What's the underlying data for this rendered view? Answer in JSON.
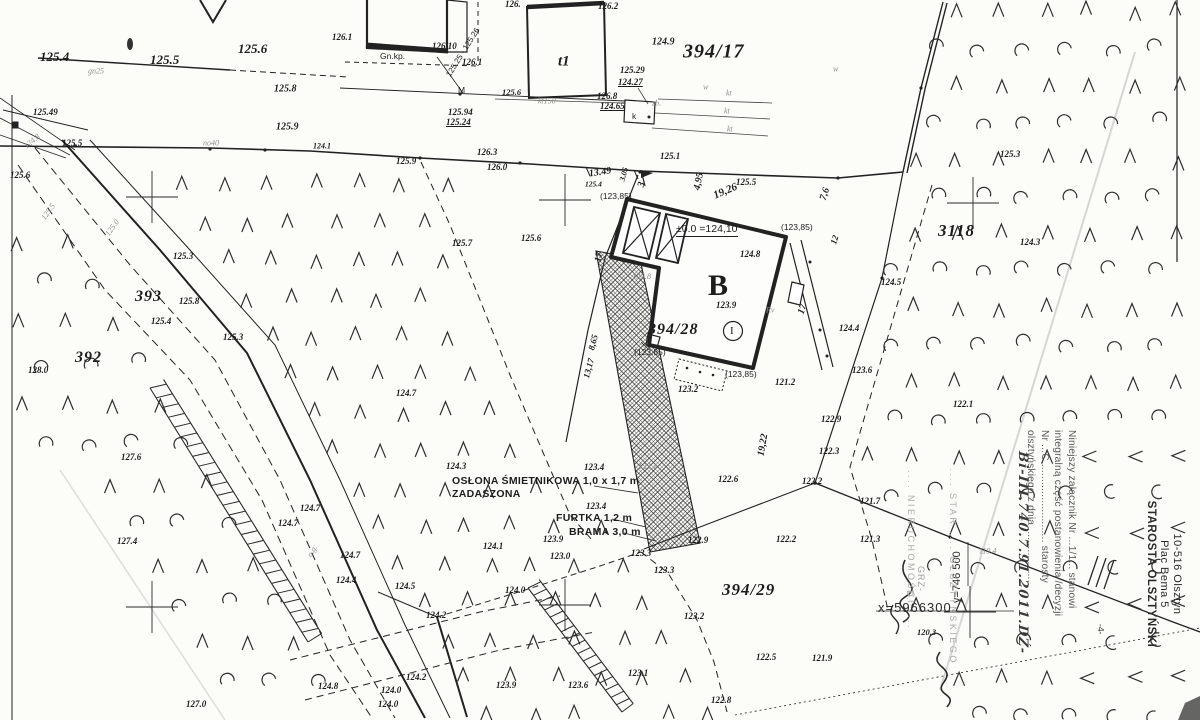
{
  "colors": {
    "ink": "#1d1d1d",
    "faint": "#8e8e8e",
    "pencil": "#bdbdbd",
    "paper": "#fcfcf8"
  },
  "labels": {
    "plot_numbers": [
      {
        "t": "394/17",
        "x": 683,
        "y": 52,
        "s": 20
      },
      {
        "t": "394/28",
        "x": 648,
        "y": 330,
        "s": 16
      },
      {
        "t": "394/29",
        "x": 722,
        "y": 590,
        "s": 17
      },
      {
        "t": "393",
        "x": 135,
        "y": 297,
        "s": 16
      },
      {
        "t": "392",
        "x": 75,
        "y": 358,
        "s": 16
      },
      {
        "t": "3118",
        "x": 938,
        "y": 231,
        "s": 17
      },
      {
        "t": "B",
        "x": 708,
        "y": 286,
        "k": "bB"
      },
      {
        "t": "t1",
        "x": 558,
        "y": 62,
        "k": "bldg"
      },
      {
        "t": "I",
        "x": 730,
        "y": 331,
        "k": "rom"
      }
    ],
    "spot_heights": [
      {
        "t": "125.4",
        "x": 40,
        "y": 57,
        "s": 13
      },
      {
        "t": "125.5",
        "x": 150,
        "y": 60,
        "s": 13
      },
      {
        "t": "125.6",
        "x": 238,
        "y": 49,
        "s": 13
      },
      {
        "t": "125.49",
        "x": 33,
        "y": 112
      },
      {
        "t": "125.5",
        "x": 62,
        "y": 143
      },
      {
        "t": "125.8",
        "x": 274,
        "y": 89,
        "s": 10
      },
      {
        "t": "125.9",
        "x": 276,
        "y": 127,
        "s": 10
      },
      {
        "t": "124.1",
        "x": 313,
        "y": 146,
        "s": 8
      },
      {
        "t": "126.1",
        "x": 332,
        "y": 37
      },
      {
        "t": "126.10",
        "x": 432,
        "y": 46
      },
      {
        "t": "126.1",
        "x": 462,
        "y": 62
      },
      {
        "t": "125.94",
        "x": 448,
        "y": 112
      },
      {
        "t": "125.24",
        "x": 446,
        "y": 122,
        "u": 1
      },
      {
        "t": "126.",
        "x": 505,
        "y": 4
      },
      {
        "t": "126.2",
        "x": 598,
        "y": 6
      },
      {
        "t": "124.9",
        "x": 652,
        "y": 42,
        "s": 10
      },
      {
        "t": "125.29",
        "x": 620,
        "y": 70
      },
      {
        "t": "124.27",
        "x": 618,
        "y": 82,
        "u": 1
      },
      {
        "t": "125.6",
        "x": 502,
        "y": 92,
        "s": 8.5
      },
      {
        "t": "126.8",
        "x": 597,
        "y": 96
      },
      {
        "t": "124.65",
        "x": 600,
        "y": 106,
        "u": 1
      },
      {
        "t": "126.3",
        "x": 477,
        "y": 152
      },
      {
        "t": "126.0",
        "x": 487,
        "y": 167
      },
      {
        "t": "125.9",
        "x": 396,
        "y": 161
      },
      {
        "t": "125.7",
        "x": 452,
        "y": 243
      },
      {
        "t": "125.6",
        "x": 521,
        "y": 238
      },
      {
        "t": "125.1",
        "x": 660,
        "y": 156
      },
      {
        "t": "125.5",
        "x": 736,
        "y": 182
      },
      {
        "t": "125.4",
        "x": 585,
        "y": 184,
        "s": 7.5
      },
      {
        "t": "124.8",
        "x": 740,
        "y": 254
      },
      {
        "t": "123.9",
        "x": 716,
        "y": 305
      },
      {
        "t": "123.8",
        "x": 632,
        "y": 276,
        "k": "gy",
        "s": 8.5
      },
      {
        "t": "123.2",
        "x": 678,
        "y": 389
      },
      {
        "t": "121.2",
        "x": 775,
        "y": 382
      },
      {
        "t": "124.5",
        "x": 881,
        "y": 282
      },
      {
        "t": "124.4",
        "x": 839,
        "y": 328
      },
      {
        "t": "123.6",
        "x": 852,
        "y": 370
      },
      {
        "t": "122.9",
        "x": 821,
        "y": 419
      },
      {
        "t": "122.1",
        "x": 953,
        "y": 404
      },
      {
        "t": "122.3",
        "x": 819,
        "y": 451
      },
      {
        "t": "122.2",
        "x": 802,
        "y": 481
      },
      {
        "t": "121.7",
        "x": 860,
        "y": 501
      },
      {
        "t": "121.3",
        "x": 860,
        "y": 539
      },
      {
        "t": "120.3",
        "x": 917,
        "y": 632,
        "s": 8.5
      },
      {
        "t": "121.9",
        "x": 812,
        "y": 658
      },
      {
        "t": "119.4",
        "x": 979,
        "y": 551,
        "k": "gy"
      },
      {
        "t": "122.6",
        "x": 718,
        "y": 479
      },
      {
        "t": "125.6",
        "x": 10,
        "y": 175
      },
      {
        "t": "125.3",
        "x": 173,
        "y": 256
      },
      {
        "t": "125.8",
        "x": 179,
        "y": 301
      },
      {
        "t": "125.4",
        "x": 151,
        "y": 321
      },
      {
        "t": "125.3",
        "x": 223,
        "y": 337
      },
      {
        "t": "128.0",
        "x": 28,
        "y": 370
      },
      {
        "t": "127.6",
        "x": 121,
        "y": 457
      },
      {
        "t": "127.4",
        "x": 117,
        "y": 541
      },
      {
        "t": "127.0",
        "x": 186,
        "y": 704
      },
      {
        "t": "124.7",
        "x": 396,
        "y": 393
      },
      {
        "t": "124.7",
        "x": 300,
        "y": 508
      },
      {
        "t": "124.7",
        "x": 278,
        "y": 523
      },
      {
        "t": "124.7",
        "x": 340,
        "y": 555
      },
      {
        "t": "124.4",
        "x": 336,
        "y": 580
      },
      {
        "t": "124.5",
        "x": 395,
        "y": 586
      },
      {
        "t": "124.2",
        "x": 426,
        "y": 615
      },
      {
        "t": "124.0",
        "x": 505,
        "y": 590
      },
      {
        "t": "124.2",
        "x": 406,
        "y": 677
      },
      {
        "t": "124.8",
        "x": 318,
        "y": 686
      },
      {
        "t": "124.0",
        "x": 381,
        "y": 690
      },
      {
        "t": "124.0",
        "x": 378,
        "y": 704
      },
      {
        "t": "123.9",
        "x": 496,
        "y": 685
      },
      {
        "t": "123.6",
        "x": 568,
        "y": 685
      },
      {
        "t": "124.3",
        "x": 446,
        "y": 466
      },
      {
        "t": "123.4",
        "x": 584,
        "y": 467
      },
      {
        "t": "123.4",
        "x": 586,
        "y": 506
      },
      {
        "t": "123.9",
        "x": 543,
        "y": 539
      },
      {
        "t": "124.1",
        "x": 483,
        "y": 546
      },
      {
        "t": "123.0",
        "x": 550,
        "y": 556
      },
      {
        "t": "123.1",
        "x": 638,
        "y": 466,
        "k": "gy",
        "s": 8.5
      },
      {
        "t": "122.9",
        "x": 688,
        "y": 540
      },
      {
        "t": "122.2",
        "x": 776,
        "y": 539
      },
      {
        "t": "123.3",
        "x": 631,
        "y": 553
      },
      {
        "t": "123.3",
        "x": 654,
        "y": 570
      },
      {
        "t": "123.2",
        "x": 684,
        "y": 616
      },
      {
        "t": "122.5",
        "x": 756,
        "y": 657
      },
      {
        "t": "123.1",
        "x": 628,
        "y": 673
      },
      {
        "t": "122.8",
        "x": 711,
        "y": 700
      },
      {
        "t": "125.3",
        "x": 1000,
        "y": 154
      },
      {
        "t": "124.3",
        "x": 1020,
        "y": 242
      }
    ],
    "dimensions": [
      {
        "t": "13.49",
        "x": 589,
        "y": 174,
        "r": -8
      },
      {
        "t": "3.05",
        "x": 622,
        "y": 181,
        "r": -75,
        "s": 8
      },
      {
        "t": "3",
        "x": 641,
        "y": 187,
        "r": -75
      },
      {
        "t": "4,95",
        "x": 697,
        "y": 190,
        "r": -78
      },
      {
        "t": "19,26",
        "x": 714,
        "y": 196,
        "r": -23,
        "s": 11
      },
      {
        "t": "7,6",
        "x": 823,
        "y": 200,
        "r": -72
      },
      {
        "t": "12",
        "x": 833,
        "y": 244,
        "r": -72,
        "s": 9
      },
      {
        "t": "17",
        "x": 598,
        "y": 262,
        "r": -78
      },
      {
        "t": "17",
        "x": 801,
        "y": 314,
        "r": -72
      },
      {
        "t": "8,65",
        "x": 591,
        "y": 350,
        "r": -75,
        "s": 9
      },
      {
        "t": "13,17",
        "x": 586,
        "y": 378,
        "r": -75,
        "s": 9
      },
      {
        "t": "19,22",
        "x": 761,
        "y": 456,
        "r": -80
      }
    ],
    "levels_paren": [
      {
        "t": "(123,85)",
        "x": 600,
        "y": 196
      },
      {
        "t": "(123,85)",
        "x": 781,
        "y": 227
      },
      {
        "t": "(123,85)",
        "x": 634,
        "y": 352
      },
      {
        "t": "(123,85)",
        "x": 725,
        "y": 374
      }
    ],
    "utilities": [
      {
        "t": "gn25",
        "x": 88,
        "y": 71
      },
      {
        "t": "no40",
        "x": 203,
        "y": 143
      },
      {
        "t": "kt150",
        "x": 538,
        "y": 101
      },
      {
        "t": "kt",
        "x": 726,
        "y": 93
      },
      {
        "t": "kt",
        "x": 724,
        "y": 111
      },
      {
        "t": "kt",
        "x": 727,
        "y": 129
      },
      {
        "t": "w",
        "x": 833,
        "y": 69
      },
      {
        "t": "w",
        "x": 703,
        "y": 87
      },
      {
        "t": "zb.",
        "x": 652,
        "y": 103
      },
      {
        "t": "k",
        "x": 632,
        "y": 116,
        "k": "par"
      },
      {
        "t": "Gn.kp.",
        "x": 380,
        "y": 56,
        "k": "par"
      },
      {
        "t": "M",
        "x": 458,
        "y": 90,
        "k": "par"
      },
      {
        "t": "o.g.",
        "x": 309,
        "y": 556,
        "r": -58
      },
      {
        "t": "125.5",
        "x": 43,
        "y": 219,
        "r": -55
      },
      {
        "t": "125.0",
        "x": 107,
        "y": 235,
        "r": -55
      },
      {
        "t": "124.8",
        "x": 25,
        "y": 147,
        "r": -40
      },
      {
        "t": "Rv",
        "x": 766,
        "y": 310
      },
      {
        "t": "125.25 · 125.26",
        "x": 448,
        "y": 76,
        "r": -58,
        "k": "par",
        "s": 8
      }
    ],
    "annotations": [
      {
        "t": "OSŁONA ŚMIETNIKOWA 1,0 x 1,7 m",
        "x": 452,
        "y": 481
      },
      {
        "t": "ZADASZONA",
        "x": 452,
        "y": 494
      },
      {
        "t": "FURTKA 1,2 m",
        "x": 556,
        "y": 518
      },
      {
        "t": "BRAMA 3,0 m",
        "x": 569,
        "y": 532
      },
      {
        "t": "±0.0 =124,10",
        "x": 676,
        "y": 230,
        "k": "lvl"
      },
      {
        "t": "-4-",
        "x": 1101,
        "y": 624,
        "r": 90,
        "k": "par"
      },
      {
        "t": "GRZ-",
        "x": 921,
        "y": 566,
        "r": 90,
        "k": "gy2"
      },
      {
        "t": "D.",
        "x": 910,
        "y": 590,
        "r": 90,
        "k": "gy2"
      }
    ]
  },
  "grid": {
    "crosses": [
      [
        152,
        197
      ],
      [
        565,
        200
      ],
      [
        973,
        203
      ],
      [
        152,
        607
      ],
      [
        565,
        605
      ],
      [
        970,
        612
      ]
    ],
    "x_label": "x=5966300",
    "y_label": "y=746 500"
  },
  "stamps": {
    "office": {
      "line1": "STAROSTA OLSZTYŃSKI",
      "line2": "Plac Bema 5",
      "line3": "10-516 Olsztyn"
    },
    "attachment": {
      "line1": "Niniejszy załącznik Nr ...1/1... stanowi",
      "line2": "integralną część postanowienia /decyzji",
      "line3": "Nr ...C........................... starosty",
      "line4": "olsztyńskiego z dnia ..................."
    },
    "handwriting": {
      "line1": "Bi-III.740.7.91.2011.DŹ-"
    },
    "faint_column1": ".... STAR .... OLSZTYŃSKIEGO",
    "faint_column2": ".... NIERUCHOMOŚCI ...."
  },
  "vegetation": {
    "road_exclusion": [
      [
        28,
        126
      ],
      [
        120,
        126
      ],
      [
        485,
        720
      ],
      [
        358,
        720
      ]
    ],
    "fields": [
      {
        "type": "conifer",
        "dx": 44,
        "dy": 38,
        "poly": [
          [
            85,
            172
          ],
          [
            448,
            172
          ],
          [
            452,
            315
          ],
          [
            538,
            448
          ],
          [
            650,
            550
          ],
          [
            740,
            718
          ],
          [
            452,
            718
          ]
        ]
      },
      {
        "type": "mixed",
        "dx": 46,
        "dy": 40,
        "poly": [
          [
            12,
            232
          ],
          [
            72,
            232
          ],
          [
            350,
            650
          ],
          [
            460,
            716
          ],
          [
            205,
            716
          ],
          [
            108,
            542
          ],
          [
            12,
            395
          ]
        ]
      },
      {
        "type": "mixed",
        "dx": 44,
        "dy": 37,
        "poly": [
          [
            945,
            0
          ],
          [
            1198,
            0
          ],
          [
            1198,
            718
          ],
          [
            950,
            718
          ],
          [
            862,
            470
          ],
          [
            905,
            170
          ]
        ]
      }
    ]
  },
  "road": {
    "ladders": [
      {
        "a": [
          150,
          388
        ],
        "b": [
          308,
          642
        ],
        "w": 16,
        "n": 26
      },
      {
        "a": [
          528,
          588
        ],
        "b": [
          622,
          712
        ],
        "w": 14,
        "n": 17
      }
    ]
  }
}
